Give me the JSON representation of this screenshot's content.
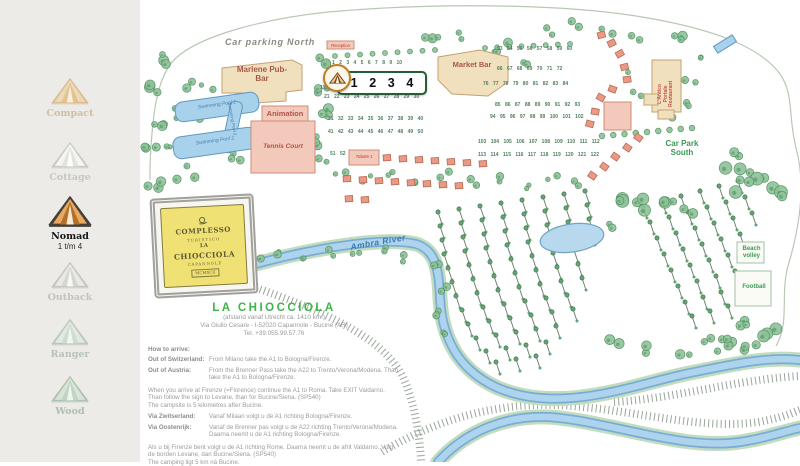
{
  "sidebar": {
    "items": [
      {
        "id": "compact",
        "label": "Compact",
        "sub": "",
        "active": false
      },
      {
        "id": "cottage",
        "label": "Cottage",
        "sub": "",
        "active": false
      },
      {
        "id": "nomad",
        "label": "Nomad",
        "sub": "1 t/m 4",
        "active": true
      },
      {
        "id": "outback",
        "label": "Outback",
        "sub": "",
        "active": false
      },
      {
        "id": "ranger",
        "label": "Ranger",
        "sub": "",
        "active": false
      },
      {
        "id": "wood",
        "label": "Wood",
        "sub": "",
        "active": false
      }
    ]
  },
  "map": {
    "labels": {
      "car_parking_north": "Car parking North",
      "marlene": "Marlene Pub-Bar",
      "market_bar": "Market Bar",
      "swimming_pool_1": "Swimming Pool 1",
      "swimming_pool_2": "Swimming Pool 2",
      "swimming_pool_3": "Swimming Pool 3",
      "animation": "Animation",
      "tennis_court": "Tennis Court",
      "reception": "Reception",
      "toilette_1": "Toilette 1",
      "antico_1": "L'Antico",
      "antico_2": "Portale",
      "antico_3": "Restaurant",
      "car_park_south": "Car Park South",
      "ambra_river": "Ambra River",
      "beach_volley": "Beach volley",
      "football": "Football"
    },
    "highlight": {
      "numbers": [
        "1",
        "2",
        "3",
        "4"
      ]
    },
    "sign": {
      "lines": [
        "COMPLESSO",
        "TURISTICO",
        "LA",
        "CHIOCCIOLA",
        "CAPANNOLE",
        "MCMXCII"
      ]
    },
    "pitch_rows": [
      {
        "x": 192,
        "y": 60,
        "numbers": [
          1,
          2,
          3,
          4,
          5,
          6,
          7,
          8,
          9,
          10
        ]
      },
      {
        "x": 180,
        "y": 85,
        "numbers": [
          11
        ]
      },
      {
        "x": 184,
        "y": 94,
        "numbers": [
          21,
          22,
          23,
          24,
          25,
          26,
          27,
          28,
          29,
          30
        ]
      },
      {
        "x": 188,
        "y": 116,
        "numbers": [
          31,
          32,
          33,
          34,
          35,
          36,
          37,
          38,
          39,
          40
        ]
      },
      {
        "x": 188,
        "y": 129,
        "numbers": [
          41,
          42,
          43,
          44,
          45,
          46,
          47,
          48,
          49,
          50
        ]
      },
      {
        "x": 190,
        "y": 151,
        "numbers": [
          51,
          52
        ]
      },
      {
        "x": 357,
        "y": 46,
        "numbers": [
          53,
          54,
          55,
          56,
          57,
          58,
          59,
          60
        ]
      },
      {
        "x": 357,
        "y": 66,
        "numbers": [
          66,
          67,
          68,
          69,
          70,
          71,
          72
        ]
      },
      {
        "x": 343,
        "y": 81,
        "numbers": [
          76,
          77,
          78,
          79,
          80,
          81,
          82,
          83,
          84
        ]
      },
      {
        "x": 355,
        "y": 102,
        "numbers": [
          85,
          86,
          87,
          88,
          89,
          90,
          91,
          92,
          93
        ]
      },
      {
        "x": 350,
        "y": 114,
        "numbers": [
          94,
          95,
          96,
          97,
          98,
          99,
          100,
          101,
          102
        ]
      },
      {
        "x": 338,
        "y": 139,
        "numbers": [
          103,
          104,
          105,
          106,
          107,
          108,
          109,
          110,
          111,
          112
        ]
      },
      {
        "x": 338,
        "y": 152,
        "numbers": [
          113,
          114,
          115,
          116,
          117,
          118,
          119,
          120,
          121,
          122
        ]
      }
    ]
  },
  "info": {
    "title": "LA CHIOCCIOLA",
    "distance": "(afstand vanaf Utrecht ca. 1410 km.)",
    "address": "Via Giulio Cesare - I-52020 Capannole - Bucine (AR)",
    "phone": "Tel. +39.055.99.57.76",
    "how_to_arrive": "How to arrive:",
    "rows": [
      {
        "label": "Out of Switzerland:",
        "text": "From Milano take the A1 to Bologna/Firenze."
      },
      {
        "label": "Out of Austria:",
        "text": "From the Brenner Pass take the A22 to Trento/Verona/Modena. Than take the A1 to Bologna/Firenze."
      }
    ],
    "para1": "When you arrive at Firenze (=Florence) continue the A1 to Roma. Take EXIT Valdarno. Than follow the sign to Levane, than for Bucine/Siena. (SP540)",
    "para1b": "The campsite is 5 kilometres after Bucine.",
    "rows2": [
      {
        "label": "Via Zwitserland:",
        "text": "Vanaf Milaan volgt u de A1 richting Bologna/Firenze."
      },
      {
        "label": "Via Oostenrijk:",
        "text": "Vanaf de Brenner pas volgt u de A22 richting Trento/Verona/Modena. Daarna neemt u de A1 richting Bologna/Firenze."
      }
    ],
    "para2": "Als u bij Firenze bent volgt u de A1 richting Rome. Daarna neemt u de afrit Valdarno. Volg de borden Levane, dan Bucine/Siena. (SP540)",
    "para3": "The camping ligt 5 km ná Bucine."
  },
  "colors": {
    "accent_green": "#3cb54a",
    "highlight_border": "#275c36",
    "badge_ring": "#bf7d22",
    "river_blue": "#79aed3",
    "building_tan": "#f0e0bd",
    "building_pink": "#f2c9ba",
    "sidebar_bg": "#ecebe8"
  }
}
